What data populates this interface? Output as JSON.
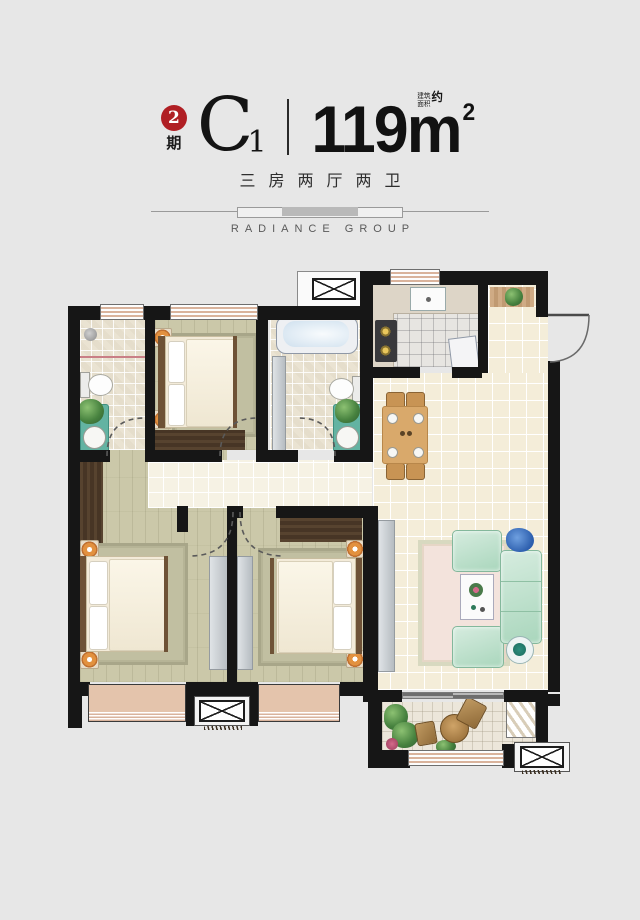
{
  "header": {
    "phase_number": "2",
    "phase_label": "期",
    "unit_letter": "C",
    "unit_number": "1",
    "area_note_line1": "建筑",
    "area_note_line2": "面积",
    "area_note_approx": "约",
    "area_value": "119",
    "area_unit": "m",
    "area_exponent": "2",
    "layout_text": "三房两厅两卫",
    "brand": "RADIANCE GROUP"
  },
  "palette": {
    "page_bg": "#e7e7e7",
    "accent_red": "#b01f24",
    "wall": "#161616",
    "window_stripe": "#d9b39c",
    "bay_fill": "#e4c4ac",
    "floor_wood": "#cbc8a9",
    "floor_tile_cream": "#f4edd9",
    "floor_tile_bath": "#eae3d2",
    "sofa_mint": "#b9dfc9",
    "rug_pink": "#f3e3dc",
    "wood_dark": "#4f3d2c",
    "table_wood": "#d9a96b"
  }
}
